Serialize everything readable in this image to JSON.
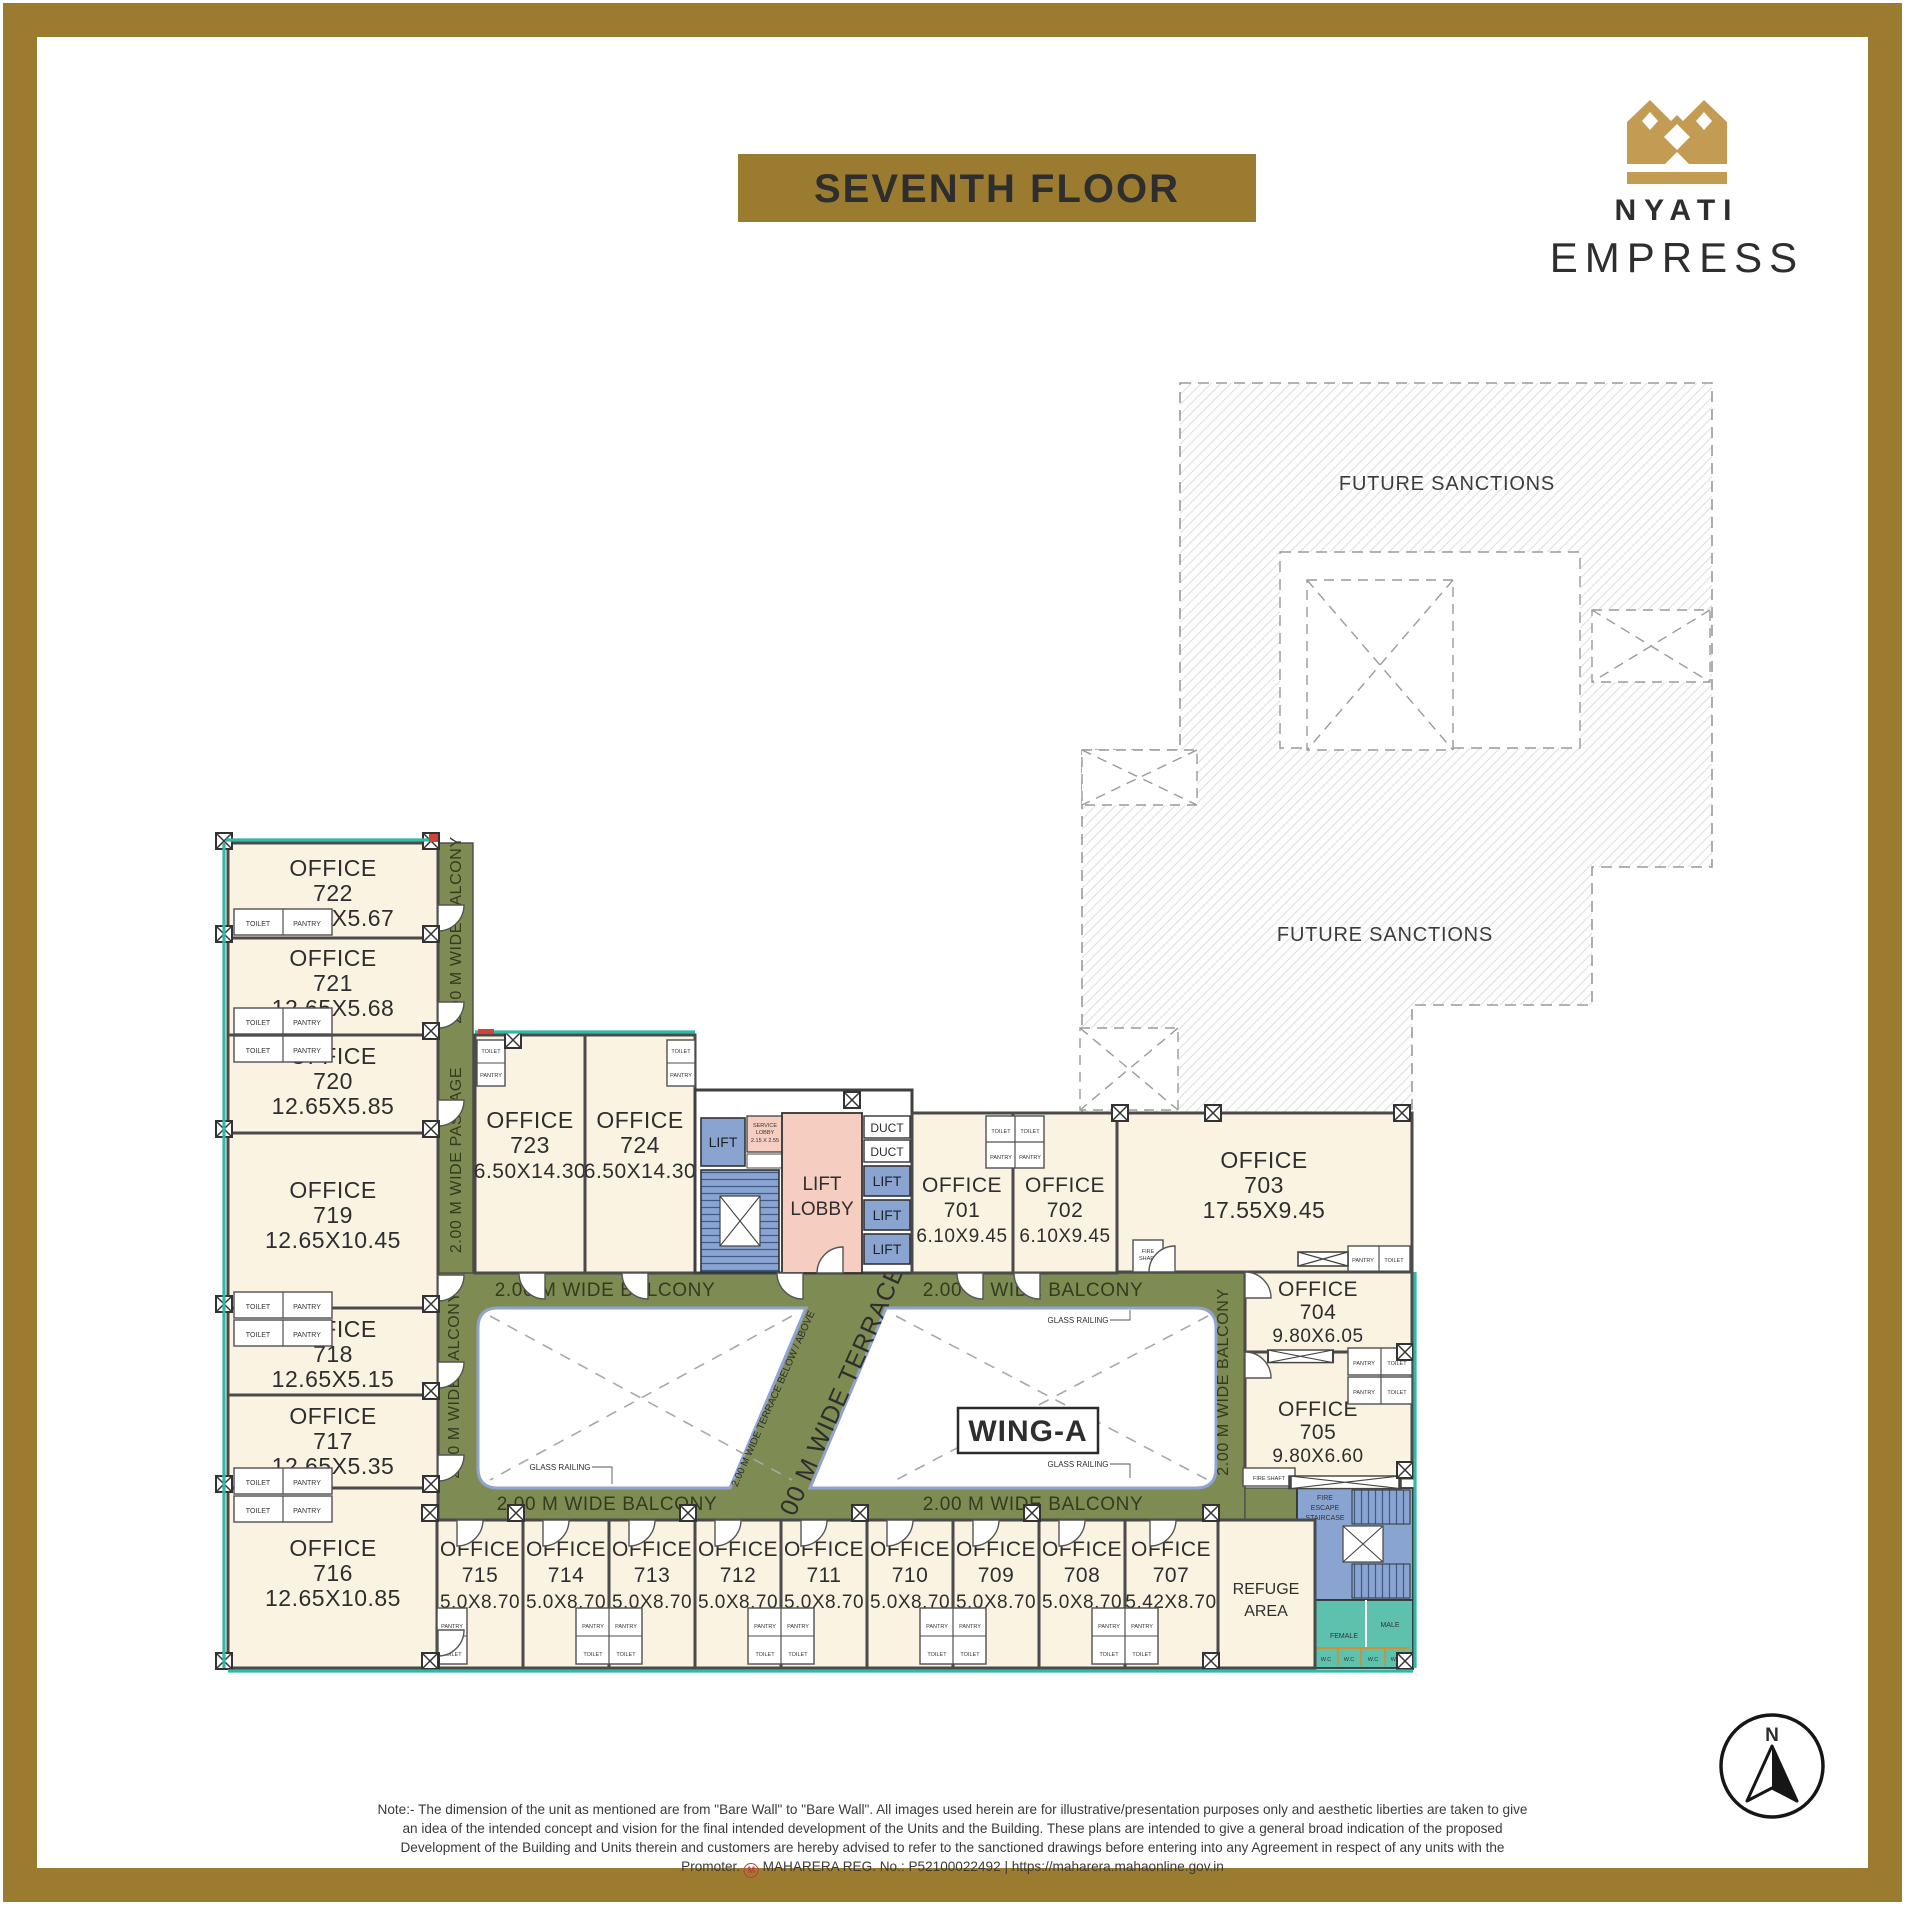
{
  "header": {
    "floor_title": "SEVENTH FLOOR",
    "brand_name": "NYATI",
    "brand_product": "EMPRESS"
  },
  "zones": {
    "future_sanctions": "FUTURE SANCTIONS",
    "wing": "WING-A",
    "refuge_1": "REFUGE",
    "refuge_2": "AREA"
  },
  "circulation": {
    "balcony": "2.00 M WIDE BALCONY",
    "passage": "2.00 M WIDE PASSAGE",
    "terrace": "2.00 M WIDE TERRACE",
    "terrace_below_above": "2.00 M WIDE TERRACE BELOW / ABOVE",
    "glass_railing": "GLASS RAILING",
    "lift": "LIFT",
    "lift_lobby_1": "LIFT",
    "lift_lobby_2": "LOBBY",
    "duct": "DUCT",
    "service_lobby_1": "SERVICE",
    "service_lobby_2": "LOBBY",
    "service_lobby_dims": "2.15 X 2.55",
    "fire_escape_1": "FIRE",
    "fire_escape_2": "ESCAPE",
    "fire_escape_3": "STAIRCASE",
    "fire_shaft_1": "FIRE",
    "fire_shaft_2": "SHAFT",
    "fire_shaft": "FIRE SHAFT"
  },
  "amenities": {
    "toilet": "TOILET",
    "pantry": "PANTRY",
    "wc": "W.C",
    "male": "MALE",
    "female": "FEMALE"
  },
  "room_label": "OFFICE",
  "offices": [
    {
      "number": "722",
      "dims": "12.65X5.67"
    },
    {
      "number": "721",
      "dims": "12.65X5.68"
    },
    {
      "number": "720",
      "dims": "12.65X5.85"
    },
    {
      "number": "719",
      "dims": "12.65X10.45"
    },
    {
      "number": "718",
      "dims": "12.65X5.15"
    },
    {
      "number": "717",
      "dims": "12.65X5.35"
    },
    {
      "number": "716",
      "dims": "12.65X10.85"
    },
    {
      "number": "723",
      "dims": "6.50X14.30"
    },
    {
      "number": "724",
      "dims": "6.50X14.30"
    },
    {
      "number": "701",
      "dims": "6.10X9.45"
    },
    {
      "number": "702",
      "dims": "6.10X9.45"
    },
    {
      "number": "703",
      "dims": "17.55X9.45"
    },
    {
      "number": "704",
      "dims": "9.80X6.05"
    },
    {
      "number": "705",
      "dims": "9.80X6.60"
    },
    {
      "number": "715",
      "dims": "5.0X8.70"
    },
    {
      "number": "714",
      "dims": "5.0X8.70"
    },
    {
      "number": "713",
      "dims": "5.0X8.70"
    },
    {
      "number": "712",
      "dims": "5.0X8.70"
    },
    {
      "number": "711",
      "dims": "5.0X8.70"
    },
    {
      "number": "710",
      "dims": "5.0X8.70"
    },
    {
      "number": "709",
      "dims": "5.0X8.70"
    },
    {
      "number": "708",
      "dims": "5.0X8.70"
    },
    {
      "number": "707",
      "dims": "5.42X8.70"
    }
  ],
  "compass": {
    "north": "N"
  },
  "note": {
    "part1": "Note:- The dimension of the unit as mentioned are from \"Bare Wall\" to \"Bare Wall\". All images used herein are for illustrative/presentation purposes only and aesthetic liberties are taken to give an idea of the intended concept and vision for the final intended development of the Units and the Building. These plans are intended to give a general broad indication of the proposed Development of the Building and Units therein and customers are hereby advised to refer to the sanctioned drawings before entering into any Agreement in respect of any units with the Promoter.",
    "rera": "MAHARERA REG. No.: P52100022492 | https://maharera.mahaonline.gov.in"
  },
  "colors": {
    "frame_gold": "#9B7B30",
    "logo_gold": "#C39B52",
    "office_fill": "#FBF3E2",
    "balcony_olive": "#7E8B52",
    "lift_blue": "#8AA4D2",
    "lobby_pink": "#F5CEC1",
    "toilet_teal": "#5EC1AE",
    "courtyard_border": "#8FA3CF"
  }
}
